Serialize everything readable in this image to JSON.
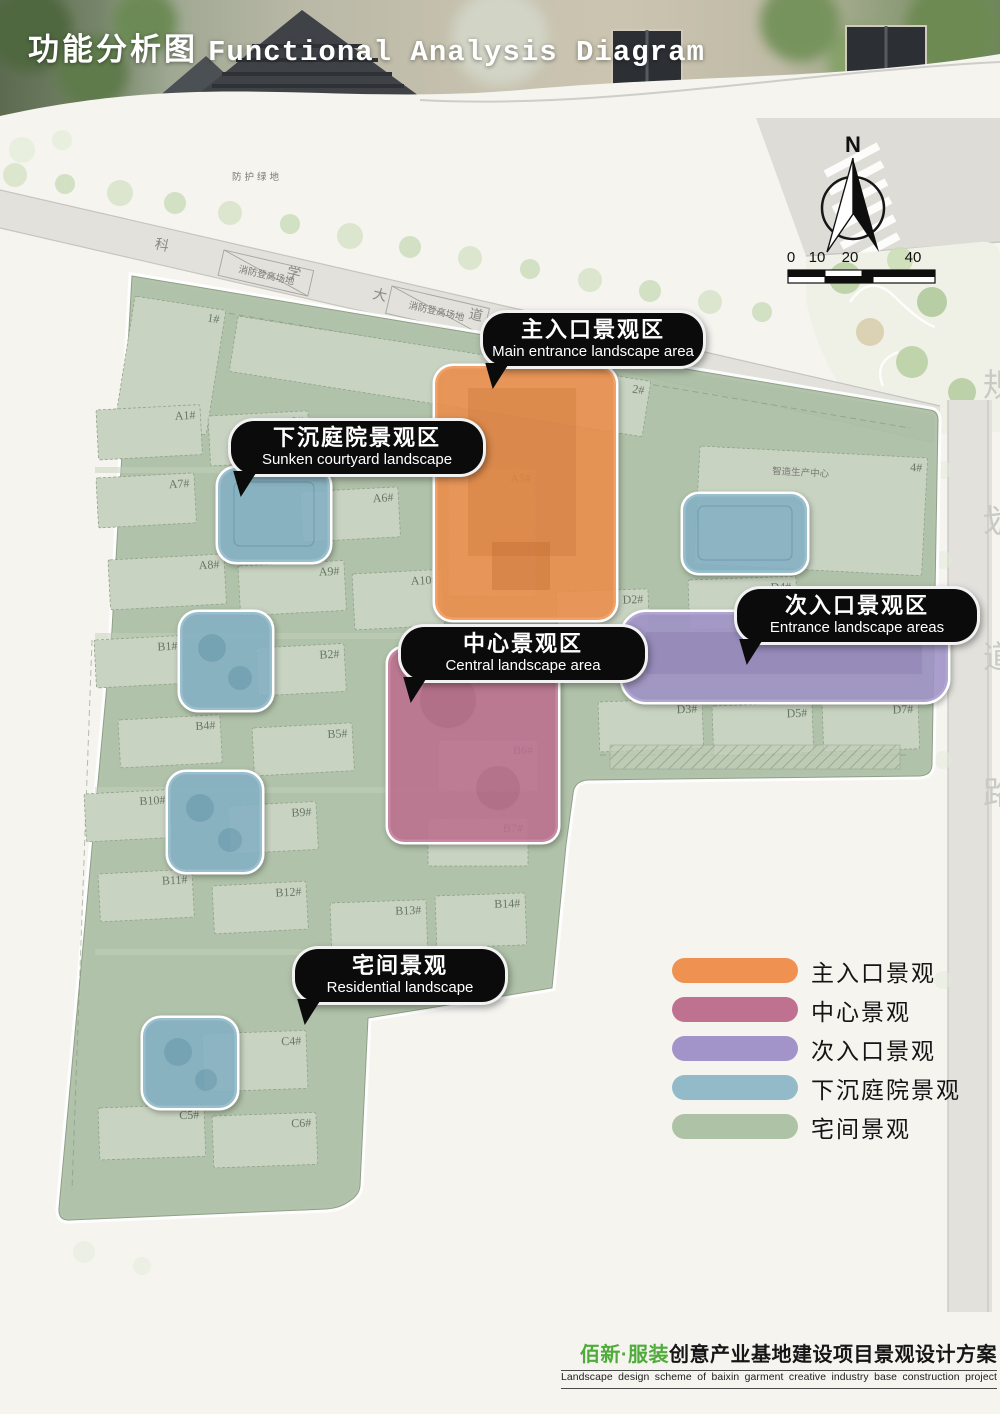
{
  "header": {
    "title_zh": "功能分析图",
    "title_en": "Functional Analysis Diagram"
  },
  "compass": {
    "north_label": "N"
  },
  "scale_bar": {
    "ticks": [
      "0",
      "10",
      "20",
      "40"
    ]
  },
  "map": {
    "protective_green_label": "防护绿地",
    "road_name_chars": [
      "科",
      "学",
      "大",
      "道"
    ],
    "fire_lane_label": "消防登高场地",
    "planning_road_text": "规划道路",
    "industry_center_label": "智造生产中心",
    "buildings": [
      {
        "label": "1#",
        "x": 135,
        "y": 296,
        "w": 92,
        "h": 126,
        "rot": 9
      },
      {
        "label": "2#",
        "x": 238,
        "y": 316,
        "w": 418,
        "h": 56,
        "rot": 9
      },
      {
        "label": "4#",
        "x": 700,
        "y": 446,
        "w": 228,
        "h": 118,
        "rot": 3
      },
      {
        "label": "A1#",
        "x": 96,
        "y": 410,
        "w": 104,
        "h": 50,
        "rot": -3
      },
      {
        "label": "A2#",
        "x": 208,
        "y": 416,
        "w": 100,
        "h": 50,
        "rot": -3
      },
      {
        "label": "A5#",
        "x": 448,
        "y": 468,
        "w": 88,
        "h": 128,
        "rot": 0
      },
      {
        "label": "A7#",
        "x": 96,
        "y": 478,
        "w": 98,
        "h": 50,
        "rot": -3
      },
      {
        "label": "A6#",
        "x": 300,
        "y": 492,
        "w": 98,
        "h": 50,
        "rot": -3
      },
      {
        "label": "A8#",
        "x": 108,
        "y": 560,
        "w": 116,
        "h": 50,
        "rot": -3
      },
      {
        "label": "A9#",
        "x": 238,
        "y": 566,
        "w": 106,
        "h": 50,
        "rot": -3
      },
      {
        "label": "A10#",
        "x": 352,
        "y": 574,
        "w": 90,
        "h": 56,
        "rot": -3
      },
      {
        "label": "D2#",
        "x": 556,
        "y": 592,
        "w": 92,
        "h": 52,
        "rot": -2
      },
      {
        "label": "D4#",
        "x": 688,
        "y": 580,
        "w": 108,
        "h": 50,
        "rot": -2
      },
      {
        "label": "B1#",
        "x": 94,
        "y": 640,
        "w": 88,
        "h": 48,
        "rot": -3
      },
      {
        "label": "B2#",
        "x": 256,
        "y": 648,
        "w": 88,
        "h": 48,
        "rot": -3
      },
      {
        "label": "B4#",
        "x": 118,
        "y": 720,
        "w": 102,
        "h": 48,
        "rot": -3
      },
      {
        "label": "B5#",
        "x": 252,
        "y": 728,
        "w": 100,
        "h": 48,
        "rot": -3
      },
      {
        "label": "B6#",
        "x": 438,
        "y": 740,
        "w": 100,
        "h": 52,
        "rot": 0
      },
      {
        "label": "B7#",
        "x": 428,
        "y": 818,
        "w": 100,
        "h": 48,
        "rot": 0
      },
      {
        "label": "B10#",
        "x": 84,
        "y": 794,
        "w": 86,
        "h": 48,
        "rot": -3
      },
      {
        "label": "B9#",
        "x": 228,
        "y": 806,
        "w": 88,
        "h": 48,
        "rot": -3
      },
      {
        "label": "B11#",
        "x": 98,
        "y": 874,
        "w": 94,
        "h": 48,
        "rot": -3
      },
      {
        "label": "B12#",
        "x": 212,
        "y": 886,
        "w": 94,
        "h": 48,
        "rot": -3
      },
      {
        "label": "B13#",
        "x": 330,
        "y": 903,
        "w": 96,
        "h": 48,
        "rot": -2
      },
      {
        "label": "B14#",
        "x": 435,
        "y": 896,
        "w": 90,
        "h": 52,
        "rot": -2
      },
      {
        "label": "D3#",
        "x": 598,
        "y": 702,
        "w": 104,
        "h": 50,
        "rot": -2
      },
      {
        "label": "D5#",
        "x": 712,
        "y": 706,
        "w": 100,
        "h": 50,
        "rot": -2
      },
      {
        "label": "D7#",
        "x": 822,
        "y": 702,
        "w": 96,
        "h": 50,
        "rot": -2
      },
      {
        "label": "C4#",
        "x": 202,
        "y": 1034,
        "w": 104,
        "h": 58,
        "rot": -2
      },
      {
        "label": "C5#",
        "x": 98,
        "y": 1108,
        "w": 106,
        "h": 52,
        "rot": -2
      },
      {
        "label": "C6#",
        "x": 212,
        "y": 1116,
        "w": 104,
        "h": 52,
        "rot": -2
      }
    ]
  },
  "callouts": [
    {
      "id": "main-entrance",
      "zh": "主入口景观区",
      "en": "Main entrance landscape area"
    },
    {
      "id": "sunken-courtyard",
      "zh": "下沉庭院景观区",
      "en": "Sunken courtyard landscape"
    },
    {
      "id": "central",
      "zh": "中心景观区",
      "en": "Central landscape area"
    },
    {
      "id": "secondary-entrance",
      "zh": "次入口景观区",
      "en": "Entrance landscape areas"
    },
    {
      "id": "residential",
      "zh": "宅间景观",
      "en": "Residential landscape"
    }
  ],
  "legend": {
    "items": [
      {
        "label": "主入口景观",
        "color": "#EF9251"
      },
      {
        "label": "中心景观",
        "color": "#BF7190"
      },
      {
        "label": "次入口景观",
        "color": "#A294C9"
      },
      {
        "label": "下沉庭院景观",
        "color": "#92BAC9"
      },
      {
        "label": "宅间景观",
        "color": "#AEC2A6"
      }
    ]
  },
  "footer": {
    "brand_zh": "佰新·服装",
    "title_zh": "创意产业基地建设项目景观设计方案",
    "subtitle_en": "Landscape design scheme of baixin garment creative industry base construction project"
  },
  "colors": {
    "paper": "#F5F4EF",
    "callout_bg": "#0B0B0B",
    "footer_green": "#4FAB3A",
    "zone_main_entrance": "#EF8F4A",
    "zone_central": "#BF7190",
    "zone_secondary_entrance": "#A294C9",
    "zone_sunken": "#85B3C6",
    "zone_residential": "#A9BDA1"
  }
}
